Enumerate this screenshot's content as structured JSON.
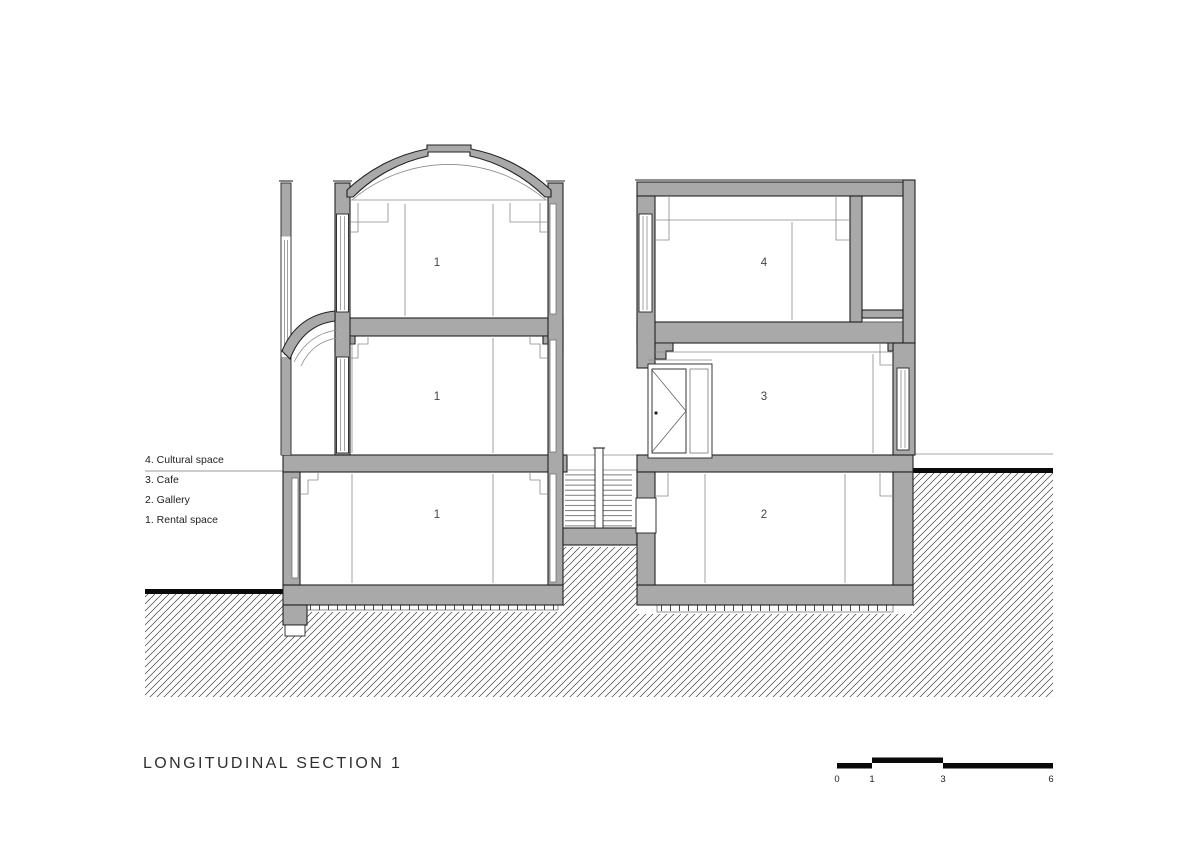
{
  "drawing": {
    "title": "LONGITUDINAL SECTION 1",
    "legend": {
      "items": [
        "4. Cultural space",
        "3. Cafe",
        "2. Gallery",
        "1. Rental space"
      ]
    },
    "room_labels": {
      "left_top": "1",
      "left_middle": "1",
      "left_bottom": "1",
      "right_top": "4",
      "right_middle": "3",
      "right_bottom": "2"
    },
    "scale_bar": {
      "labels": [
        "0",
        "1",
        "3",
        "6"
      ]
    },
    "colors": {
      "wall_fill": "#a9a9a9",
      "outline": "#222222",
      "hatch_line": "#3f3f3f",
      "ground_line": "#0a0a0a",
      "background": "#ffffff"
    }
  }
}
